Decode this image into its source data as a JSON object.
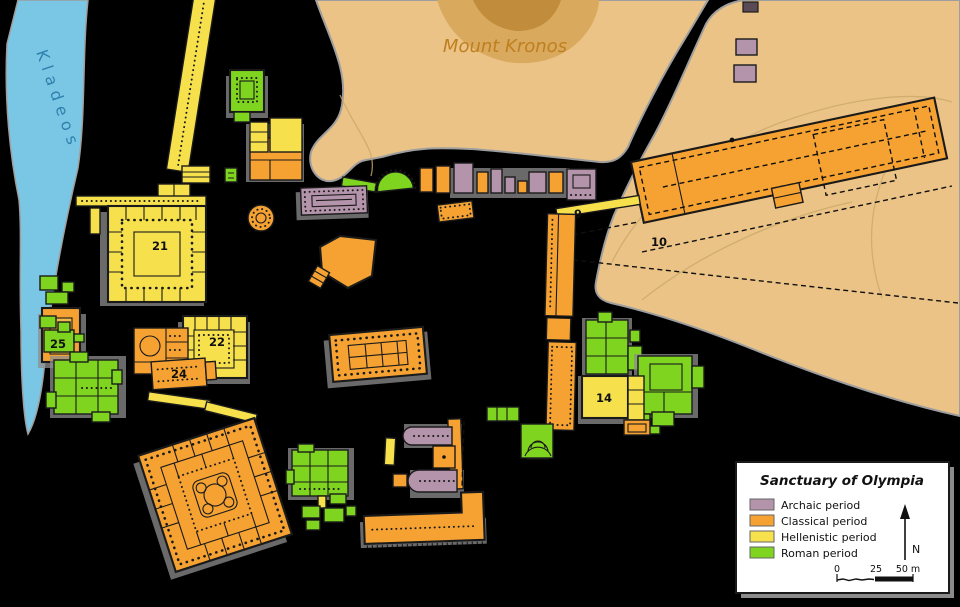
{
  "map": {
    "river": {
      "label": "Kladeos"
    },
    "hill": {
      "label": "Mount Kronos"
    },
    "labels": [
      {
        "text": "21"
      },
      {
        "text": "22"
      },
      {
        "text": "24"
      },
      {
        "text": "25"
      },
      {
        "text": "9"
      },
      {
        "text": "10"
      },
      {
        "text": "14"
      }
    ]
  },
  "legend": {
    "title": "Sanctuary of Olympia",
    "items": [
      {
        "key": "archaic",
        "label": "Archaic period",
        "color": "#b494aa"
      },
      {
        "key": "classical",
        "label": "Classical period",
        "color": "#f5a233"
      },
      {
        "key": "hellenistic",
        "label": "Hellenistic period",
        "color": "#f6e14d"
      },
      {
        "key": "roman",
        "label": "Roman period",
        "color": "#7fd420"
      }
    ],
    "north_label": "N",
    "scale_ticks": [
      "0",
      "25",
      "50 m"
    ]
  },
  "colors": {
    "bg": "#000000",
    "river": "#7ac7e5",
    "river_label": "#2f81ad",
    "hill": "#ebc386",
    "hill_shade": "#d9a95e",
    "hill_peak": "#c18c3c",
    "hill_label": "#bf7f1f",
    "outline": "#1a1a1a",
    "shadow": "#8d8d8d",
    "edge": "#9e9e9e"
  }
}
